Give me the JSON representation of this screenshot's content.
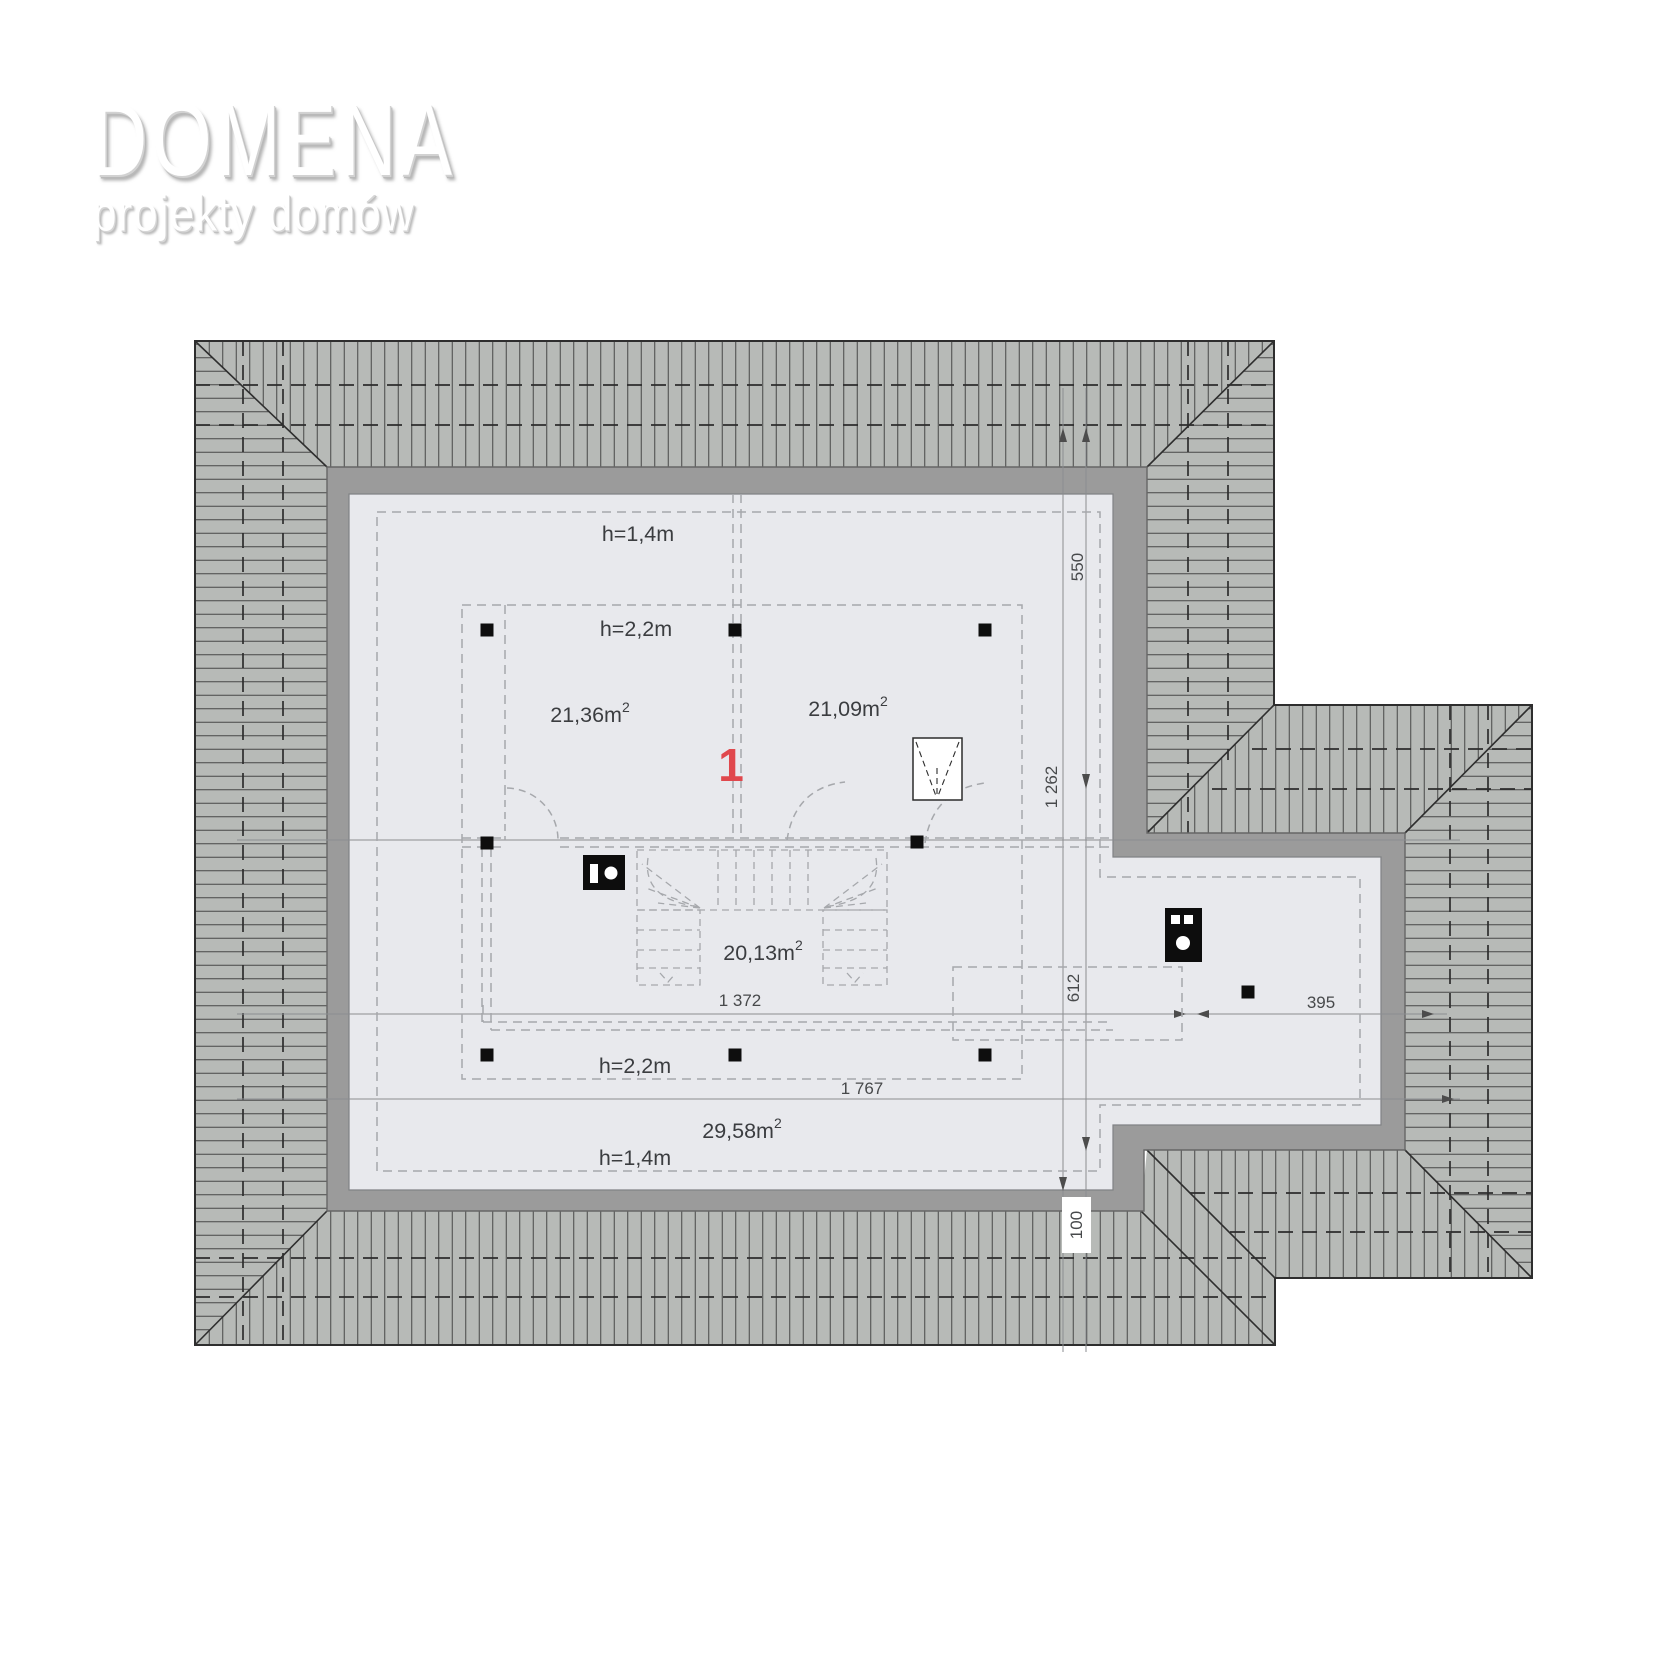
{
  "logo": {
    "title": "DOMENA",
    "subtitle": "projekty domów"
  },
  "plan": {
    "unit_number": "1",
    "height_zones": {
      "top_low": "h=1,4m",
      "top_high": "h=2,2m",
      "bottom_high": "h=2,2m",
      "bottom_low": "h=1,4m"
    },
    "room_areas": {
      "left": {
        "value": "21,36m",
        "sup": "2"
      },
      "right": {
        "value": "21,09m",
        "sup": "2"
      },
      "stair_hall": {
        "value": "20,13m",
        "sup": "2"
      },
      "south": {
        "value": "29,58m",
        "sup": "2"
      }
    },
    "dimensions": {
      "right_top": "550",
      "right_mid": "1 262",
      "extension_depth": "612",
      "wall_offset": "100",
      "interior_width": "1 372",
      "extension_width": "395",
      "total_width": "1 767"
    },
    "icons": {
      "chimney_main": "chimney-icon",
      "chimney_extension": "chimney-icon",
      "roof_window": "roof-window-icon",
      "columns": "column-post"
    },
    "colors": {
      "roof": "#b7bab7",
      "wall": "#9b9b9b",
      "interior": "#e8e9ed",
      "accent_red": "#e0484d",
      "line_dark": "#2e2e2e",
      "dashed_light": "#a6a8ac"
    }
  }
}
